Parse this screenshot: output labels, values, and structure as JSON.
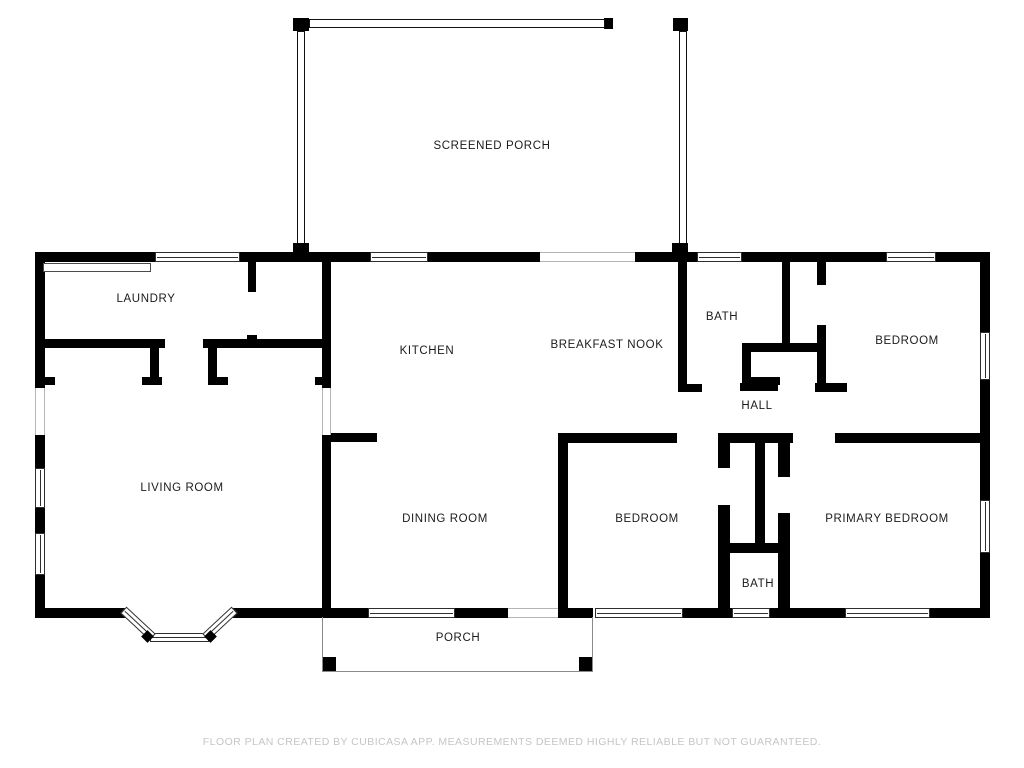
{
  "title": "Floor plan",
  "colors": {
    "wall": "#000000",
    "label_text": "#1b1b1b",
    "footer_text": "#c5c5c5",
    "thin_line": "#8a8a8a"
  },
  "footer": {
    "text": "FLOOR PLAN CREATED BY CUBICASA APP. MEASUREMENTS DEEMED HIGHLY RELIABLE BUT NOT GUARANTEED."
  },
  "rooms": [
    {
      "id": "screened-porch",
      "label": "SCREENED PORCH",
      "x": 492,
      "y": 146
    },
    {
      "id": "laundry",
      "label": "LAUNDRY",
      "x": 146,
      "y": 299
    },
    {
      "id": "kitchen",
      "label": "KITCHEN",
      "x": 427,
      "y": 351
    },
    {
      "id": "breakfast-nook",
      "label": "BREAKFAST NOOK",
      "x": 607,
      "y": 345
    },
    {
      "id": "bath-upper",
      "label": "BATH",
      "x": 722,
      "y": 317
    },
    {
      "id": "bedroom-upper",
      "label": "BEDROOM",
      "x": 907,
      "y": 341
    },
    {
      "id": "hall",
      "label": "HALL",
      "x": 757,
      "y": 406
    },
    {
      "id": "living-room",
      "label": "LIVING ROOM",
      "x": 182,
      "y": 488
    },
    {
      "id": "dining-room",
      "label": "DINING ROOM",
      "x": 445,
      "y": 519
    },
    {
      "id": "bedroom-lower",
      "label": "BEDROOM",
      "x": 647,
      "y": 519
    },
    {
      "id": "primary-bedroom",
      "label": "PRIMARY BEDROOM",
      "x": 887,
      "y": 519
    },
    {
      "id": "bath-lower",
      "label": "BATH",
      "x": 758,
      "y": 584
    },
    {
      "id": "porch",
      "label": "PORCH",
      "x": 458,
      "y": 638
    }
  ],
  "walls": [
    [
      35,
      252,
      120,
      10
    ],
    [
      240,
      252,
      130,
      10
    ],
    [
      428,
      252,
      112,
      10
    ],
    [
      635,
      252,
      62,
      10
    ],
    [
      742,
      252,
      144,
      10
    ],
    [
      936,
      252,
      54,
      10
    ],
    [
      35,
      252,
      10,
      136
    ],
    [
      35,
      435,
      10,
      33
    ],
    [
      35,
      508,
      10,
      25
    ],
    [
      35,
      575,
      10,
      43
    ],
    [
      980,
      252,
      10,
      80
    ],
    [
      980,
      380,
      10,
      120
    ],
    [
      980,
      553,
      10,
      65
    ],
    [
      35,
      608,
      93,
      10
    ],
    [
      230,
      608,
      138,
      10
    ],
    [
      455,
      608,
      53,
      10
    ],
    [
      558,
      608,
      35,
      10
    ],
    [
      683,
      608,
      49,
      10
    ],
    [
      770,
      608,
      75,
      10
    ],
    [
      930,
      608,
      60,
      10
    ],
    [
      322,
      262,
      9,
      126
    ],
    [
      248,
      262,
      8,
      30
    ],
    [
      247,
      335,
      10,
      10
    ],
    [
      41,
      339,
      124,
      9
    ],
    [
      203,
      339,
      127,
      9
    ],
    [
      150,
      348,
      9,
      30
    ],
    [
      208,
      348,
      9,
      30
    ],
    [
      41,
      377,
      14,
      8
    ],
    [
      142,
      377,
      20,
      8
    ],
    [
      208,
      377,
      20,
      8
    ],
    [
      315,
      377,
      15,
      8
    ],
    [
      322,
      433,
      55,
      9
    ],
    [
      322,
      435,
      9,
      175
    ],
    [
      558,
      433,
      10,
      185
    ],
    [
      558,
      433,
      119,
      10
    ],
    [
      678,
      262,
      9,
      130
    ],
    [
      678,
      384,
      24,
      8
    ],
    [
      782,
      262,
      8,
      90
    ],
    [
      742,
      343,
      83,
      9
    ],
    [
      742,
      352,
      9,
      33
    ],
    [
      751,
      377,
      29,
      8
    ],
    [
      817,
      262,
      9,
      23
    ],
    [
      817,
      325,
      9,
      67
    ],
    [
      740,
      383,
      38,
      8
    ],
    [
      815,
      383,
      32,
      9
    ],
    [
      718,
      433,
      75,
      10
    ],
    [
      835,
      433,
      155,
      10
    ],
    [
      718,
      443,
      12,
      25
    ],
    [
      718,
      505,
      12,
      113
    ],
    [
      755,
      443,
      10,
      104
    ],
    [
      778,
      443,
      12,
      34
    ],
    [
      778,
      513,
      12,
      105
    ],
    [
      730,
      543,
      60,
      10
    ],
    [
      604,
      18,
      9,
      11
    ]
  ],
  "windows_h": [
    [
      155,
      252,
      85,
      10
    ],
    [
      370,
      252,
      58,
      10
    ],
    [
      697,
      252,
      45,
      10
    ],
    [
      886,
      252,
      50,
      10
    ],
    [
      368,
      608,
      87,
      10
    ],
    [
      595,
      608,
      88,
      10
    ],
    [
      732,
      608,
      38,
      10
    ],
    [
      845,
      608,
      85,
      10
    ],
    [
      150,
      633,
      59,
      9
    ]
  ],
  "windows_v": [
    [
      35,
      468,
      10,
      40
    ],
    [
      35,
      533,
      10,
      42
    ],
    [
      980,
      332,
      10,
      48
    ],
    [
      980,
      500,
      10,
      53
    ]
  ],
  "bay_windows": [
    {
      "x": 118,
      "y": 619,
      "w": 40,
      "h": 9,
      "angle": 43
    },
    {
      "x": 200,
      "y": 619,
      "w": 40,
      "h": 9,
      "angle": -43
    }
  ],
  "bay_joints": [
    {
      "x": 143,
      "y": 632,
      "w": 9,
      "h": 9,
      "angle": 45
    },
    {
      "x": 206,
      "y": 632,
      "w": 9,
      "h": 9,
      "angle": 45
    }
  ],
  "openings_v": [
    [
      35,
      388,
      10,
      47
    ],
    [
      322,
      388,
      9,
      47
    ]
  ],
  "openings_h": [
    [
      540,
      252,
      95,
      10
    ],
    [
      508,
      608,
      50,
      10
    ]
  ],
  "screens_v": [
    [
      297,
      31,
      8,
      214
    ],
    [
      679,
      31,
      8,
      214
    ]
  ],
  "screens_h": [
    [
      309,
      19,
      296,
      9
    ]
  ],
  "posts": [
    [
      293,
      18,
      16,
      13
    ],
    [
      673,
      18,
      15,
      13
    ],
    [
      293,
      243,
      16,
      19
    ],
    [
      672,
      243,
      16,
      19
    ],
    [
      322,
      657,
      14,
      15
    ],
    [
      579,
      657,
      14,
      15
    ]
  ],
  "fixtures": [
    [
      43,
      263,
      108,
      9
    ]
  ],
  "porch_outline": [
    322,
    617,
    271,
    55
  ]
}
